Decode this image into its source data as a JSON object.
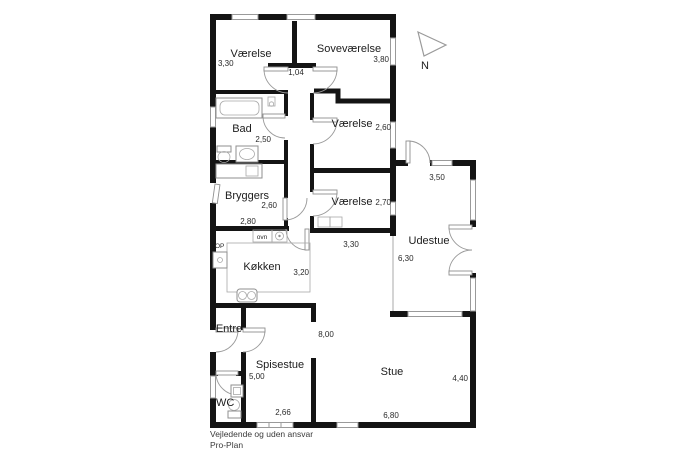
{
  "plan": {
    "rooms": {
      "vaerelse_nw": {
        "name": "Værelse",
        "dim": "3,30"
      },
      "sovevaerelse": {
        "name": "Soveværelse",
        "dim": "3,80"
      },
      "hall_top": {
        "dim": "1,04"
      },
      "bad": {
        "name": "Bad",
        "dim": "2,50"
      },
      "bryggers": {
        "name": "Bryggers",
        "dim_a": "2,60",
        "dim_b": "2,80"
      },
      "vaerelse_mid": {
        "name": "Værelse",
        "dim": "2,60"
      },
      "vaerelse_s": {
        "name": "Værelse",
        "dim": "2,70"
      },
      "gang": {
        "dim": "3,30"
      },
      "udestue": {
        "name": "Udestue",
        "dim_a": "6,30",
        "dim_b": "3,50"
      },
      "koekken": {
        "name": "Køkken",
        "dim": "3,20"
      },
      "hall": {
        "dim": "8,00"
      },
      "entre": {
        "name": "Entre"
      },
      "spisestue": {
        "name": "Spisestue",
        "dim_a": "5,00",
        "dim_b": "2,66"
      },
      "wc": {
        "name": "WC"
      },
      "stue": {
        "name": "Stue",
        "dim_a": "4,40",
        "dim_b": "6,80"
      }
    },
    "annotations": {
      "oven": "ovn",
      "stairs_up": "OP"
    },
    "compass": {
      "north": "N"
    },
    "footer": {
      "line1": "Vejledende og uden ansvar",
      "line2": "Pro-Plan"
    },
    "colors": {
      "wall": "#141414",
      "thin": "#9a9a9a",
      "background": "#ffffff"
    }
  }
}
